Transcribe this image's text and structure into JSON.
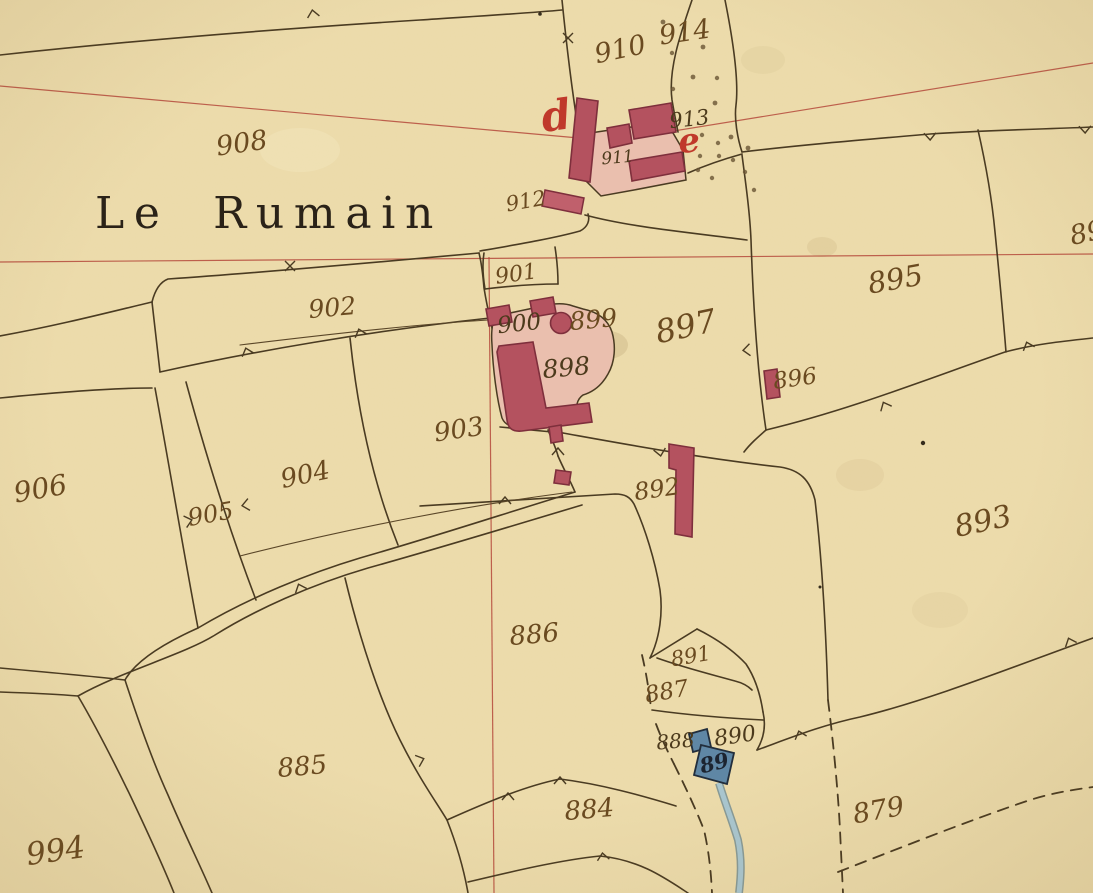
{
  "map": {
    "title": "Le Rumain",
    "labels": {
      "p908": "908",
      "p910": "910",
      "p914": "914",
      "p913": "913",
      "p911": "911",
      "p912": "912",
      "p901": "901",
      "p902": "902",
      "p900": "900",
      "p899": "899",
      "p897": "897",
      "p895": "895",
      "p896": "896",
      "p898": "898",
      "p903": "903",
      "p904": "904",
      "p905": "905",
      "p906": "906",
      "p892": "892",
      "p893": "893",
      "p886": "886",
      "p891": "891",
      "p887": "887",
      "p888": "888",
      "p890": "890",
      "p889": "89",
      "p879": "879",
      "p885": "885",
      "p884": "884",
      "p994": "994",
      "p89_partial": "89",
      "letter_d": "d",
      "letter_e": "e"
    },
    "colors": {
      "paper": "#efe0b2",
      "boundary_ink": "#4a3b22",
      "label_ink": "#6a4a20",
      "survey_line_red": "#b5493b",
      "building_red": "#b4525f",
      "courtyard_pink": "#eabfae",
      "water_blue": "#5f87a5",
      "stream_blue": "#a9c6cf",
      "title_ink": "#2a2218"
    }
  }
}
